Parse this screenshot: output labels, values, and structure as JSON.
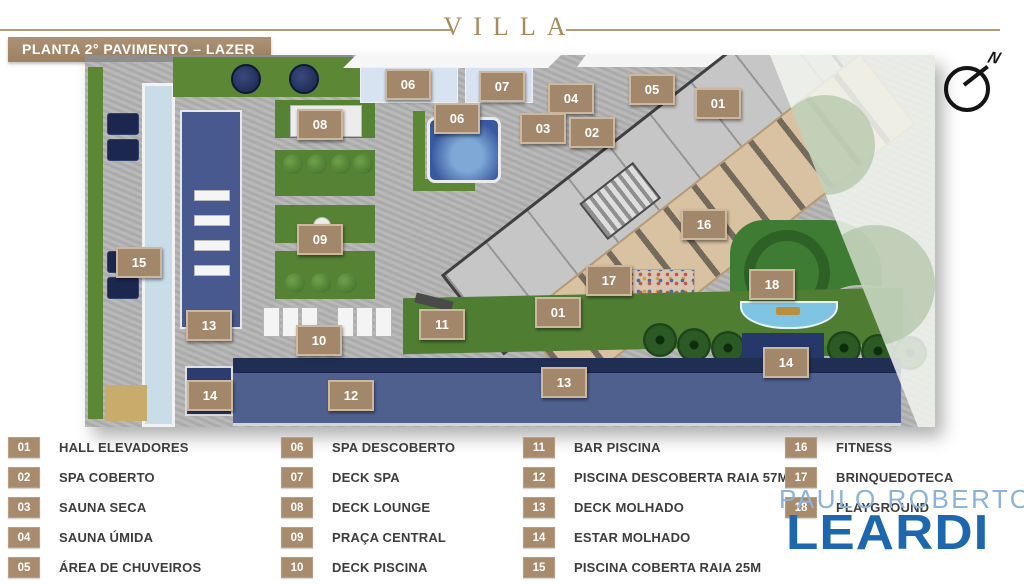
{
  "header": {
    "brand": "VILLA",
    "banner": "PLANTA 2° PAVIMENTO – LAZER",
    "compass": "N"
  },
  "plan": {
    "tags": [
      {
        "n": "06",
        "x": 406,
        "y": 82
      },
      {
        "n": "07",
        "x": 500,
        "y": 84
      },
      {
        "n": "06",
        "x": 455,
        "y": 116
      },
      {
        "n": "04",
        "x": 569,
        "y": 96
      },
      {
        "n": "03",
        "x": 541,
        "y": 126
      },
      {
        "n": "02",
        "x": 590,
        "y": 130
      },
      {
        "n": "05",
        "x": 650,
        "y": 87
      },
      {
        "n": "01",
        "x": 716,
        "y": 101
      },
      {
        "n": "08",
        "x": 318,
        "y": 122
      },
      {
        "n": "09",
        "x": 318,
        "y": 237
      },
      {
        "n": "10",
        "x": 317,
        "y": 338
      },
      {
        "n": "15",
        "x": 137,
        "y": 260
      },
      {
        "n": "13",
        "x": 207,
        "y": 323
      },
      {
        "n": "14",
        "x": 208,
        "y": 393
      },
      {
        "n": "12",
        "x": 349,
        "y": 393
      },
      {
        "n": "11",
        "x": 440,
        "y": 322
      },
      {
        "n": "01",
        "x": 556,
        "y": 310
      },
      {
        "n": "17",
        "x": 607,
        "y": 278
      },
      {
        "n": "13",
        "x": 562,
        "y": 380
      },
      {
        "n": "16",
        "x": 702,
        "y": 222
      },
      {
        "n": "18",
        "x": 770,
        "y": 282
      },
      {
        "n": "14",
        "x": 784,
        "y": 360
      }
    ]
  },
  "legend": {
    "columns": [
      [
        {
          "num": "01",
          "label": "HALL ELEVADORES"
        },
        {
          "num": "02",
          "label": "SPA COBERTO"
        },
        {
          "num": "03",
          "label": "SAUNA SECA"
        },
        {
          "num": "04",
          "label": "SAUNA ÚMIDA"
        },
        {
          "num": "05",
          "label": "ÁREA DE CHUVEIROS"
        }
      ],
      [
        {
          "num": "06",
          "label": "SPA DESCOBERTO"
        },
        {
          "num": "07",
          "label": "DECK SPA"
        },
        {
          "num": "08",
          "label": "DECK LOUNGE"
        },
        {
          "num": "09",
          "label": "PRAÇA CENTRAL"
        },
        {
          "num": "10",
          "label": "DECK PISCINA"
        }
      ],
      [
        {
          "num": "11",
          "label": "BAR PISCINA"
        },
        {
          "num": "12",
          "label": "PISCINA DESCOBERTA RAIA 57M"
        },
        {
          "num": "13",
          "label": "DECK MOLHADO"
        },
        {
          "num": "14",
          "label": "ESTAR MOLHADO"
        },
        {
          "num": "15",
          "label": "PISCINA COBERTA RAIA 25M"
        }
      ],
      [
        {
          "num": "16",
          "label": "FITNESS"
        },
        {
          "num": "17",
          "label": "BRINQUEDOTECA"
        },
        {
          "num": "18",
          "label": "PLAYGROUND"
        }
      ]
    ]
  },
  "watermark": {
    "line1": "PAULO ROBERTO",
    "line2": "LEARDI"
  },
  "colors": {
    "tan_accent": "#a3876a",
    "gold_brand": "#a98a5e",
    "pool_navy": "#2c3c6e",
    "pool_light": "#c9dde8",
    "grass_green": "#4f7e33",
    "wood_deck": "#d8c2a1",
    "watermark_light_blue": "#8cb3da",
    "watermark_blue": "#1c67ad"
  }
}
